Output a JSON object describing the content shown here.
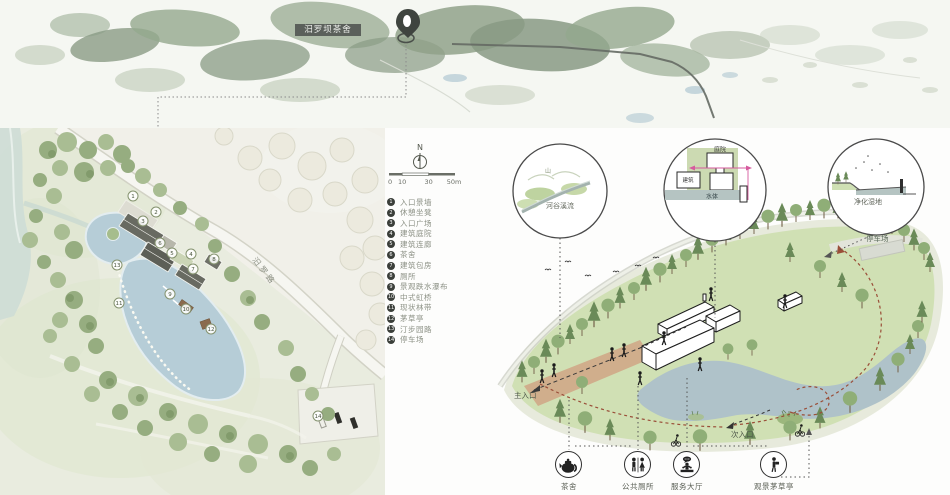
{
  "colors": {
    "forest_green": "#7e9179",
    "plan_water": "#b6cdd7",
    "axon_water": "#afc2c9",
    "landform_green": "#d0e0b4",
    "magenta_accent": "#d65a9e",
    "route_red": "#9a4e38",
    "site_tag_background": "#5b605b"
  },
  "map": {
    "pin_label": "汨罗坝茶舍"
  },
  "plan": {
    "compass": "N",
    "scale_labels": [
      "0",
      "10",
      "30",
      "50m"
    ],
    "road_label": "汨罗路",
    "legend_items": [
      {
        "num": "1",
        "label": "入口景墙"
      },
      {
        "num": "2",
        "label": "休憩坐凳"
      },
      {
        "num": "3",
        "label": "入口广场"
      },
      {
        "num": "4",
        "label": "建筑庭院"
      },
      {
        "num": "5",
        "label": "建筑连廊"
      },
      {
        "num": "6",
        "label": "茶舍"
      },
      {
        "num": "7",
        "label": "建筑包房"
      },
      {
        "num": "8",
        "label": "厕所"
      },
      {
        "num": "9",
        "label": "景观跌水瀑布"
      },
      {
        "num": "10",
        "label": "中式虹桥"
      },
      {
        "num": "11",
        "label": "现状林带"
      },
      {
        "num": "12",
        "label": "茅草亭"
      },
      {
        "num": "13",
        "label": "汀步园路"
      },
      {
        "num": "14",
        "label": "停车场"
      }
    ]
  },
  "axon": {
    "callouts": {
      "stream": {
        "hill": "山",
        "caption": "河谷溪流"
      },
      "courtyard": {
        "top": "庭院",
        "left": "建筑",
        "bottom": "水体"
      },
      "wetland": {
        "caption": "净化湿地"
      }
    },
    "labels": {
      "main_entrance": "主入口",
      "secondary_entrance": "次入口",
      "parking": "停车场"
    },
    "facilities": [
      {
        "icon": "teapot-icon",
        "label": "茶舍"
      },
      {
        "icon": "restroom-icon",
        "label": "公共厕所"
      },
      {
        "icon": "service-hall-icon",
        "label": "服务大厅"
      },
      {
        "icon": "viewing-pavilion-icon",
        "label": "观景茅草亭"
      }
    ]
  }
}
